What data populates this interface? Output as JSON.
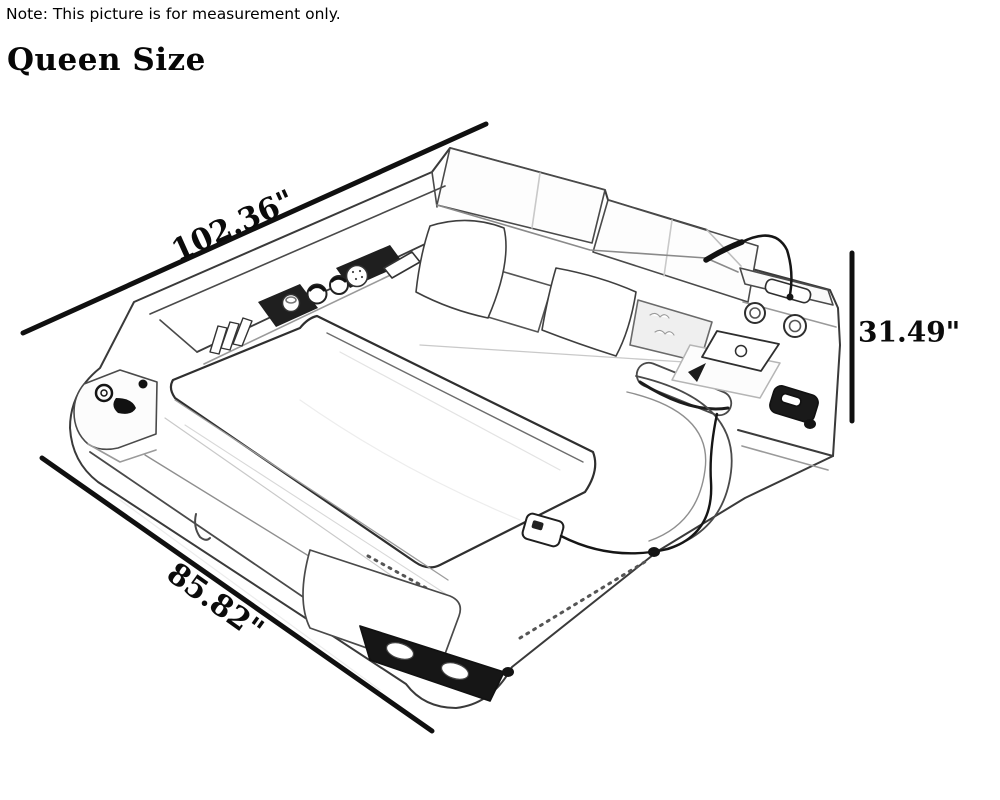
{
  "note": "Note: This picture is for measurement only.",
  "title": "Queen Size",
  "dimensions": {
    "length": {
      "label": "102.36\"",
      "inches": 102.36
    },
    "width": {
      "label": "85.82\"",
      "inches": 85.82
    },
    "height": {
      "label": "31.49\"",
      "inches": 31.49
    }
  }
}
